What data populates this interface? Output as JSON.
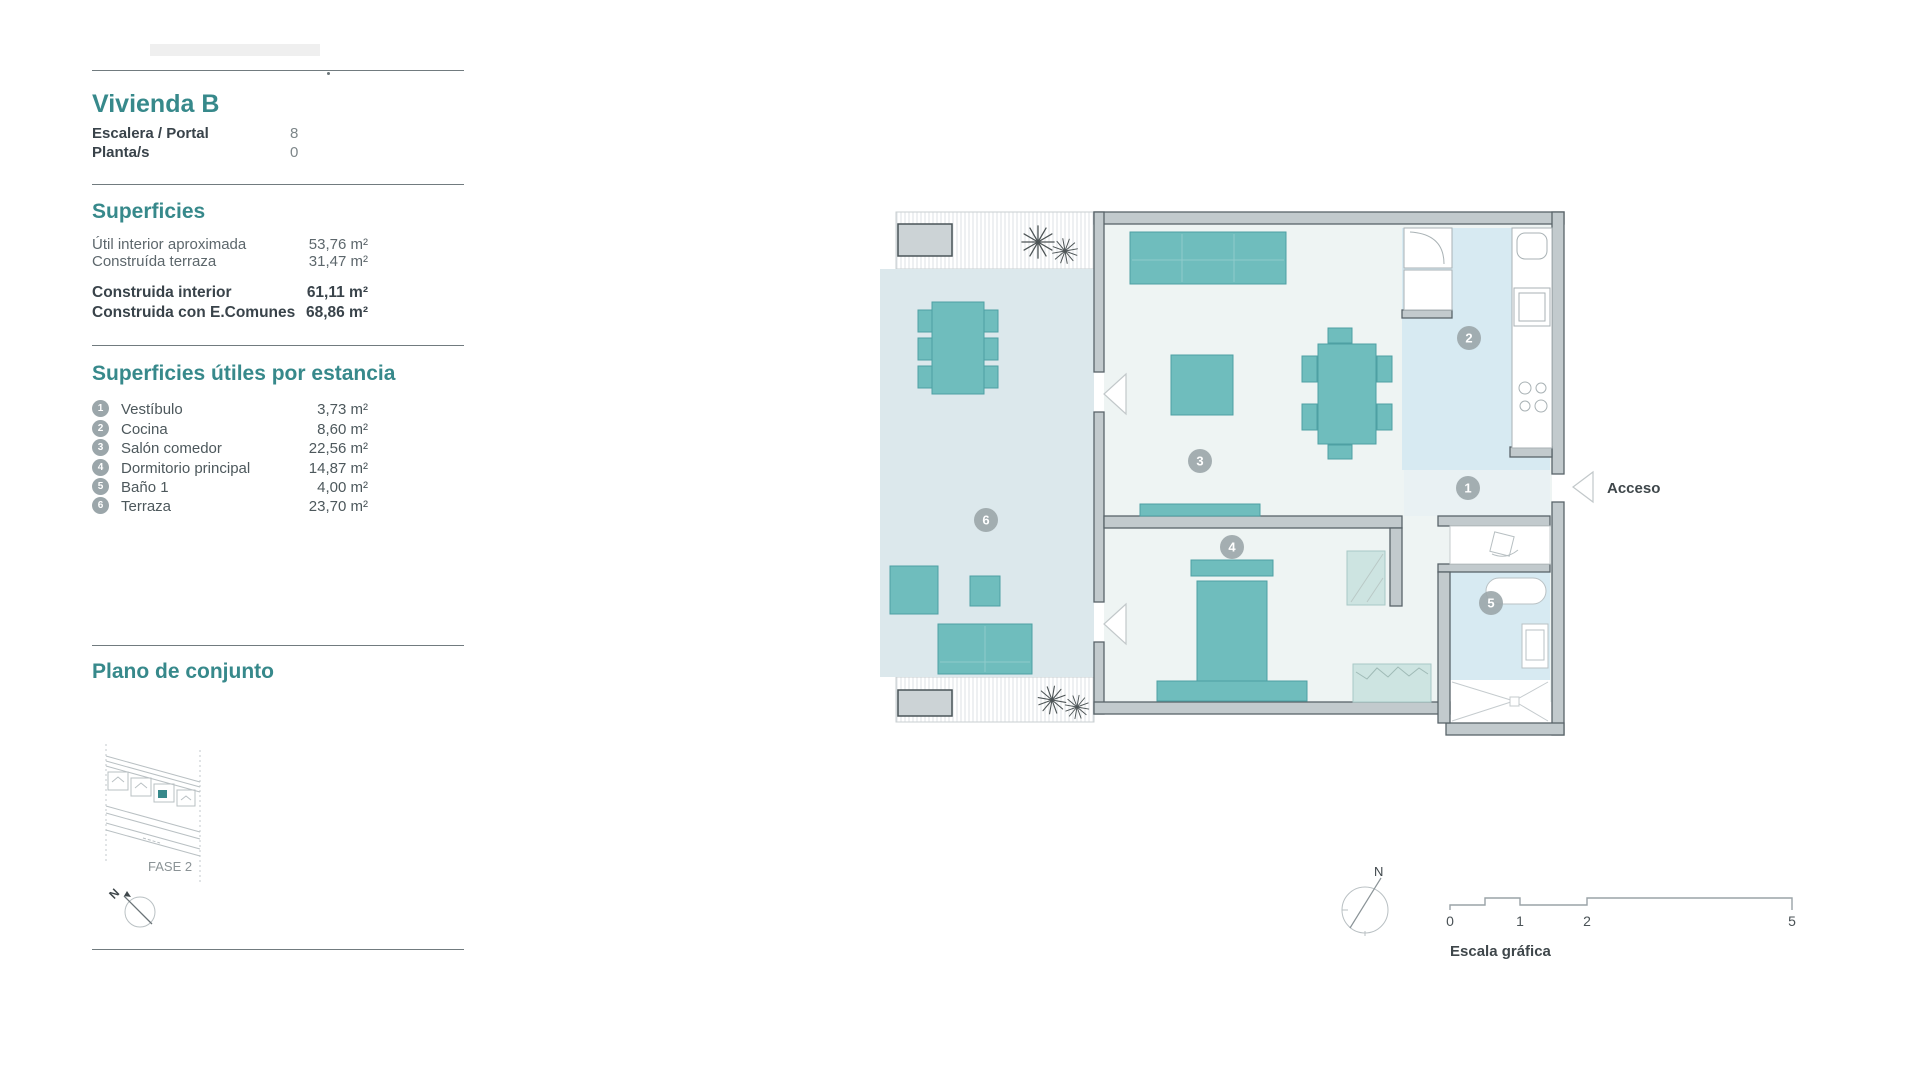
{
  "sidebar": {
    "unit": {
      "title": "Vivienda B",
      "rows": [
        {
          "label": "Escalera / Portal",
          "value": "8"
        },
        {
          "label": "Planta/s",
          "value": "0"
        }
      ]
    },
    "superficies": {
      "title": "Superficies",
      "rows": [
        {
          "label": "Útil interior aproximada",
          "value": "53,76 m²"
        },
        {
          "label": "Construída terraza",
          "value": "31,47 m²"
        },
        {
          "label": "Construida interior",
          "value": "61,11 m²"
        },
        {
          "label": "Construida con E.Comunes",
          "value": "68,86 m²"
        }
      ]
    },
    "estancias": {
      "title": "Superficies útiles por estancia",
      "items": [
        {
          "num": "1",
          "label": "Vestíbulo",
          "value": "3,73 m²"
        },
        {
          "num": "2",
          "label": "Cocina",
          "value": "8,60 m²"
        },
        {
          "num": "3",
          "label": "Salón comedor",
          "value": "22,56 m²"
        },
        {
          "num": "4",
          "label": "Dormitorio principal",
          "value": "14,87 m²"
        },
        {
          "num": "5",
          "label": "Baño 1",
          "value": "4,00 m²"
        },
        {
          "num": "6",
          "label": "Terraza",
          "value": "23,70 m²"
        }
      ]
    },
    "plano_conjunto": {
      "title": "Plano de conjunto",
      "phase_label": "FASE 2",
      "north_label": "N"
    }
  },
  "plan": {
    "access_label": "Acceso",
    "north_label": "N",
    "badge_numbers": [
      "1",
      "2",
      "3",
      "4",
      "5",
      "6"
    ],
    "scale": {
      "title": "Escala gráfica",
      "ticks": [
        "0",
        "1",
        "2",
        "5"
      ]
    },
    "colors": {
      "accent": "#37898b",
      "furniture_teal": "#6fbdbd",
      "terrace_floor": "#dce8ec",
      "interior_floor": "#eef4f3",
      "wet_room_floor": "#d7eaf2",
      "light_cabinet": "#cde4e1",
      "wall_gray": "#c2cacd",
      "badge_gray": "#9ba6aa"
    }
  }
}
